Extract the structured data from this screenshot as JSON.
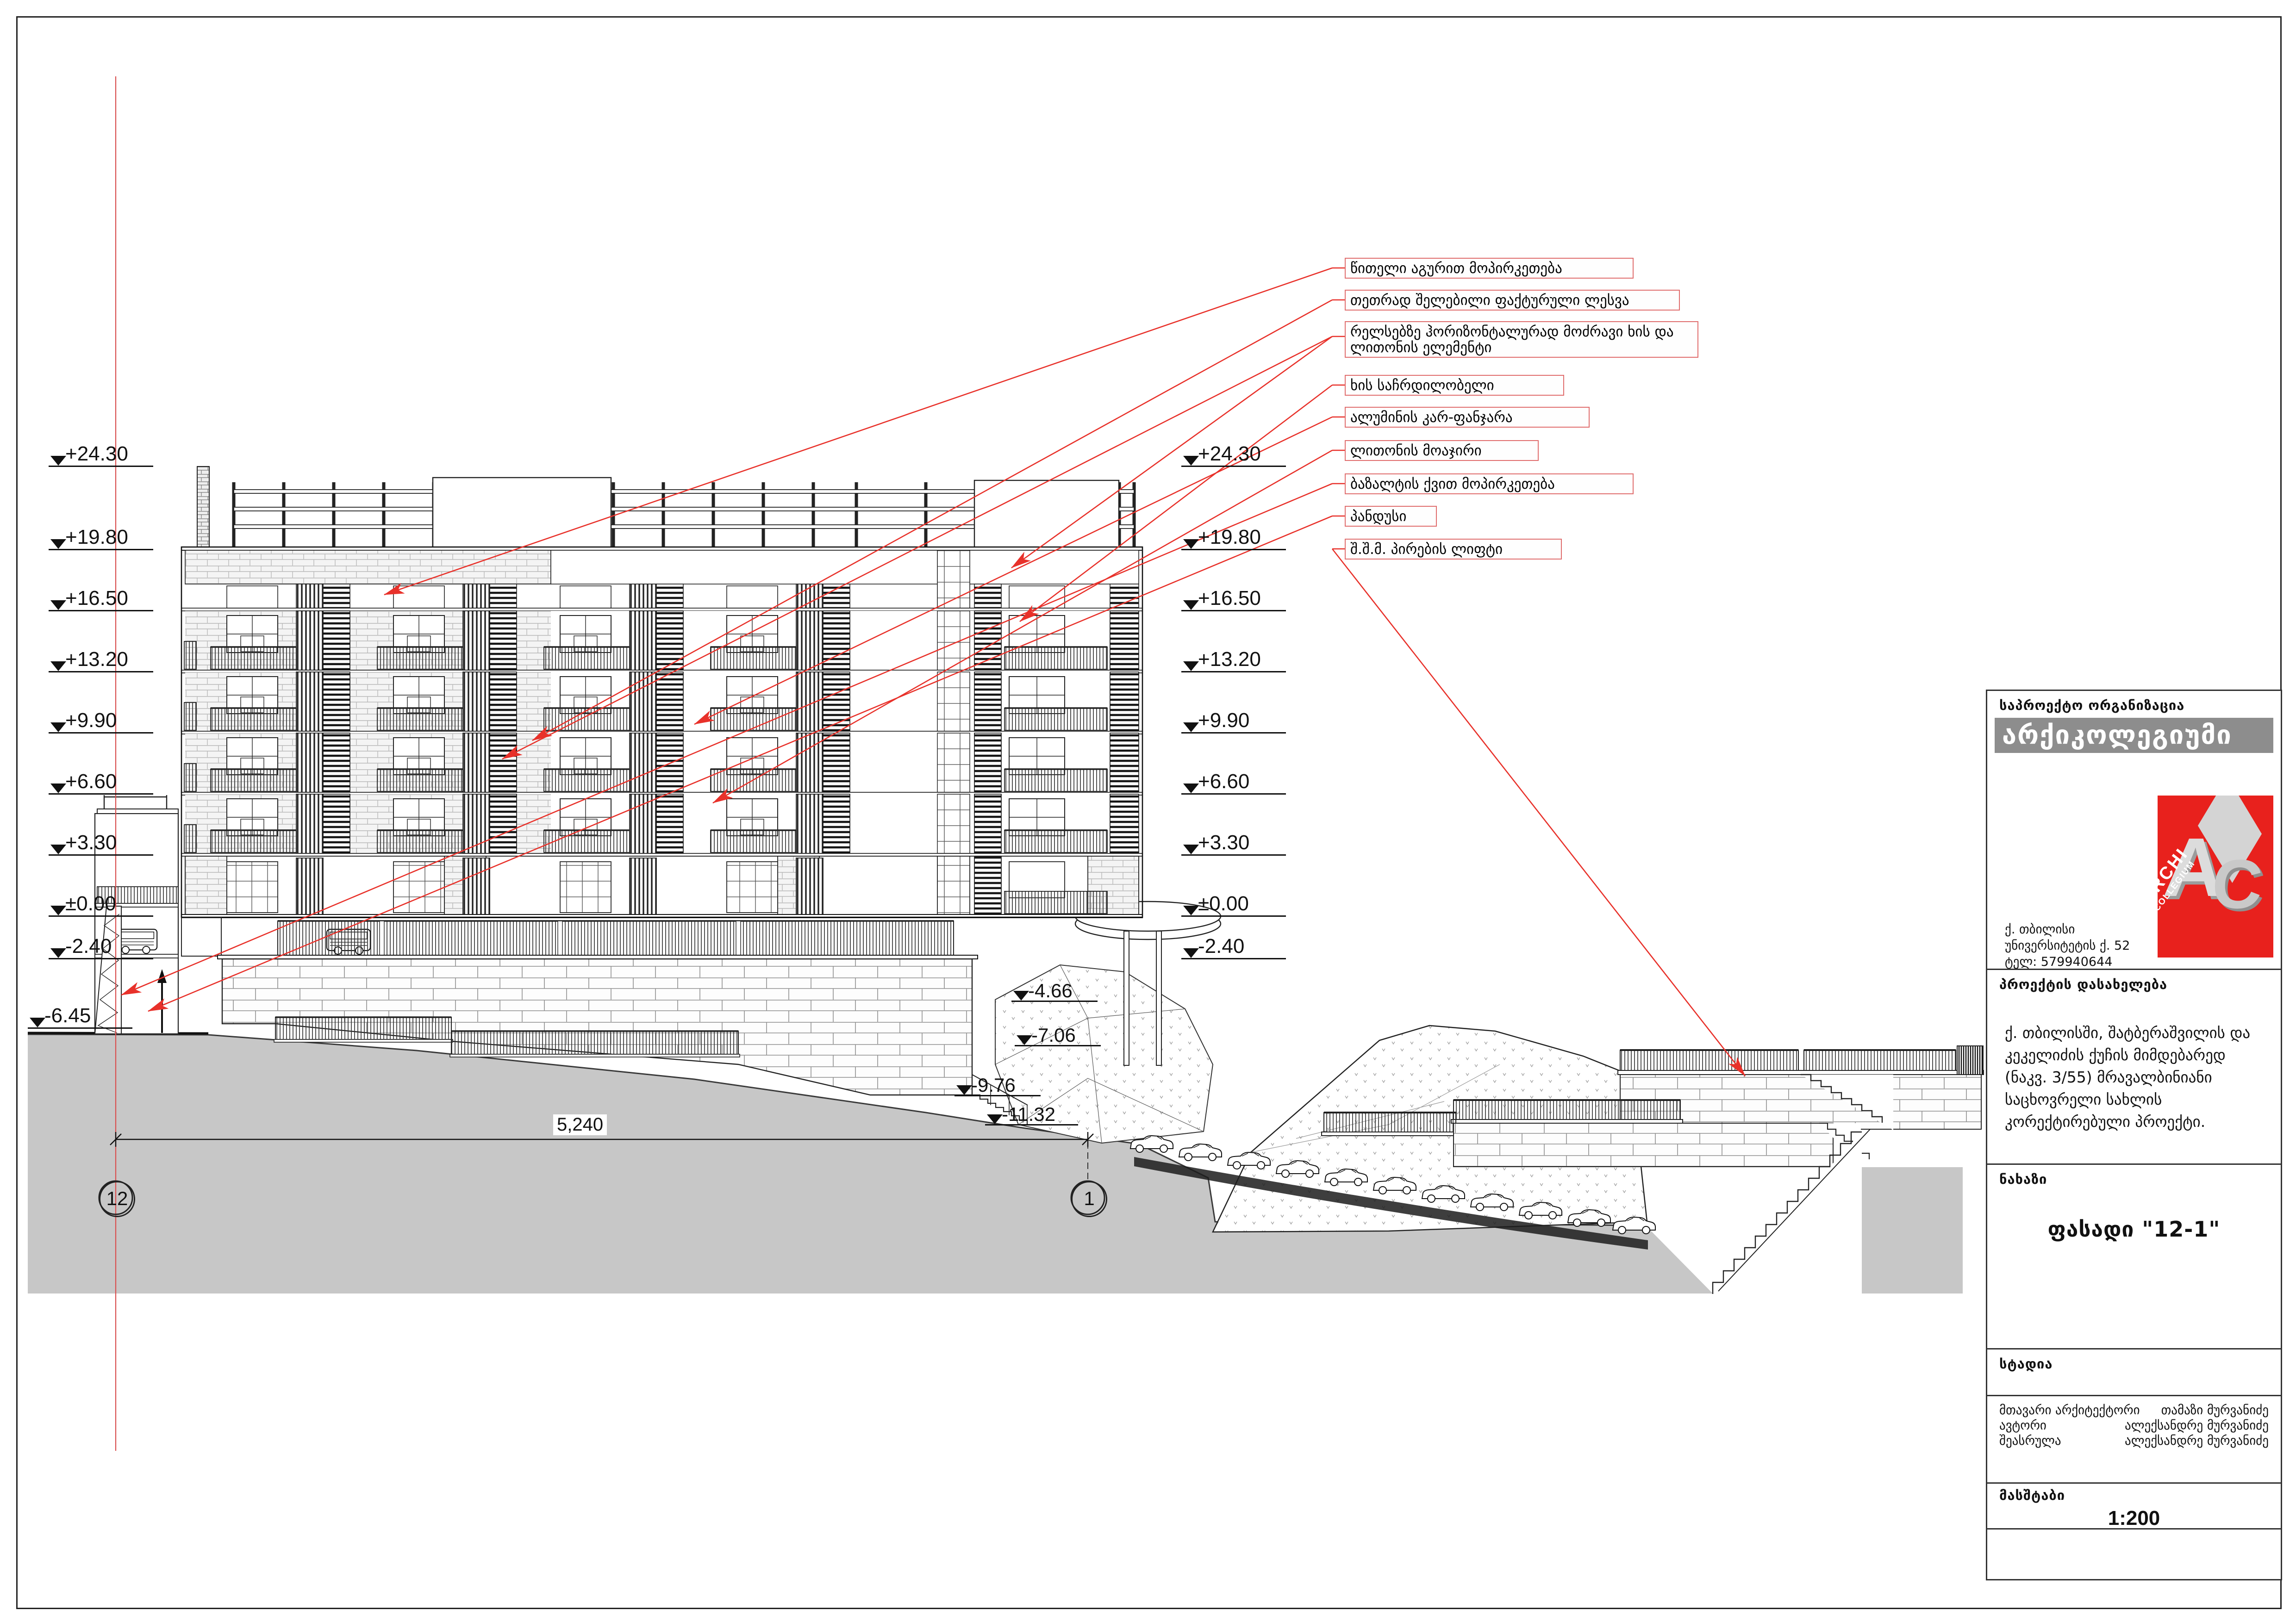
{
  "sheet": {
    "dimension_total": "5,240",
    "grid_bubbles": {
      "left": "12",
      "right": "1"
    }
  },
  "levels": {
    "left": [
      "+24.30",
      "+19.80",
      "+16.50",
      "+13.20",
      "+9.90",
      "+6.60",
      "+3.30",
      "±0.00",
      "-2.40",
      "-6.45"
    ],
    "right": [
      "+24.30",
      "+19.80",
      "+16.50",
      "+13.20",
      "+9.90",
      "+6.60",
      "+3.30",
      "±0.00",
      "-2.40"
    ],
    "depth": [
      "-4.66",
      "-7.06",
      "-9.76",
      "-11.32"
    ]
  },
  "annotations": {
    "labels": [
      {
        "text": "წითელი აგურით მოპირკეთება"
      },
      {
        "text": "თეთრად შელებილი ფაქტურული ლესვა"
      },
      {
        "text": "რელსებზე ჰორიზონტალურად მოძრავი ხის და ლითონის ელემენტი"
      },
      {
        "text": "ხის საჩრდილობელი"
      },
      {
        "text": "ალუმინის კარ-ფანჯარა"
      },
      {
        "text": "ლითონის მოაჯირი"
      },
      {
        "text": "ბაზალტის ქვით მოპირკეთება"
      },
      {
        "text": "პანდუსი"
      },
      {
        "text": "შ.შ.მ. პირების ლიფტი"
      }
    ]
  },
  "title_block": {
    "org_label": "საპროექტო ორგანიზაცია",
    "org_name": "არქიკოლეგიუმი",
    "logo": {
      "letter_a": "A",
      "letter_c": "C",
      "line1": "ARCHI",
      "line2": "COLLEGIUM"
    },
    "address_lines": [
      "ქ. თბილისი",
      "უნივერსიტეტის ქ. 52",
      "ტელ: 579940644"
    ],
    "project_label": "პროექტის დასახელება",
    "project_description": "ქ. თბილისში, შატბერაშვილის და კეკელიძის ქუჩის მიმდებარედ (ნაკვ. 3/55) მრავალბინიანი საცხოვრელი სახლის კორექტირებული პროექტი.",
    "drawing_label": "ნახაზი",
    "drawing_title": "ფასადი \"12-1\"",
    "stage_label": "სტადია",
    "credits": [
      {
        "role": "მთავარი არქიტექტორი",
        "name": "თამაზი მურვანიძე"
      },
      {
        "role": "ავტორი",
        "name": "ალექსანდრე მურვანიძე"
      },
      {
        "role": "შეასრულა",
        "name": "ალექსანდრე მურვანიძე"
      }
    ],
    "scale_label": "მასშტაბი",
    "scale_value": "1:200"
  }
}
